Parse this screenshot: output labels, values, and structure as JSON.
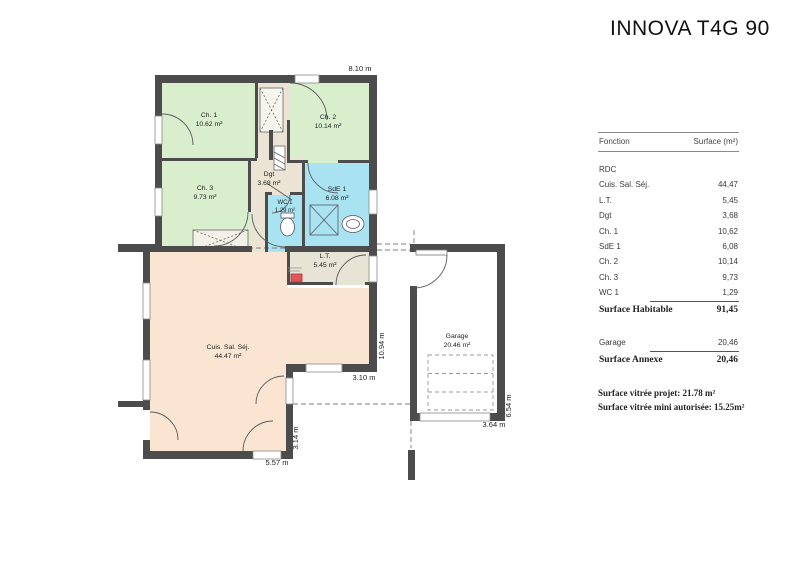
{
  "title": "INNOVA T4G 90",
  "plan": {
    "rooms": {
      "ch1": {
        "name": "Ch. 1",
        "area": "10.62 m²"
      },
      "ch2": {
        "name": "Ch. 2",
        "area": "10.14 m²"
      },
      "ch3": {
        "name": "Ch. 3",
        "area": "9.73 m²"
      },
      "dgt": {
        "name": "Dgt",
        "area": "3.68 m²"
      },
      "wc1": {
        "name": "WC 1",
        "area": "1.29 m²"
      },
      "sde1": {
        "name": "SdE 1",
        "area": "6.08 m²"
      },
      "lt": {
        "name": "L.T.",
        "area": "5.45 m²"
      },
      "cuis": {
        "name": "Cuis. Sal. Séj.",
        "area": "44.47 m²"
      },
      "garage": {
        "name": "Garage",
        "area": "20.46 m²"
      }
    },
    "dims": {
      "top": "8.10 m",
      "right": "10.94 m",
      "step": "3.10 m",
      "step_v": "3.14 m",
      "bottom": "5.57 m",
      "garage_w": "3.64 m",
      "garage_h": "6.54 m"
    },
    "colors": {
      "bedroom": "#d9eecd",
      "bath": "#a9e3f2",
      "hall": "#ebe4d5",
      "tech": "#e7e3d5",
      "living": "#f9e5d2",
      "garage": "#ffffff",
      "wall": "#4c4c4c",
      "boiler": "#e05656"
    }
  },
  "table": {
    "header": {
      "function": "Fonction",
      "surface": "Surface (m²)"
    },
    "level": "RDC",
    "rows": [
      {
        "label": "Cuis. Sal. Séj.",
        "value": "44,47"
      },
      {
        "label": "L.T.",
        "value": "5,45"
      },
      {
        "label": "Dgt",
        "value": "3,68"
      },
      {
        "label": "Ch. 1",
        "value": "10,62"
      },
      {
        "label": "SdE 1",
        "value": "6,08"
      },
      {
        "label": "Ch. 2",
        "value": "10,14"
      },
      {
        "label": "Ch. 3",
        "value": "9,73"
      },
      {
        "label": "WC 1",
        "value": "1,29"
      }
    ],
    "total": {
      "label": "Surface Habitable",
      "value": "91,45"
    },
    "annex_row": {
      "label": "Garage",
      "value": "20,46"
    },
    "annex_total": {
      "label": "Surface Annexe",
      "value": "20,46"
    },
    "notes": [
      "Surface vitrée projet:  21.78 m²",
      "Surface vitrée mini autorisée:  15.25m²"
    ]
  }
}
